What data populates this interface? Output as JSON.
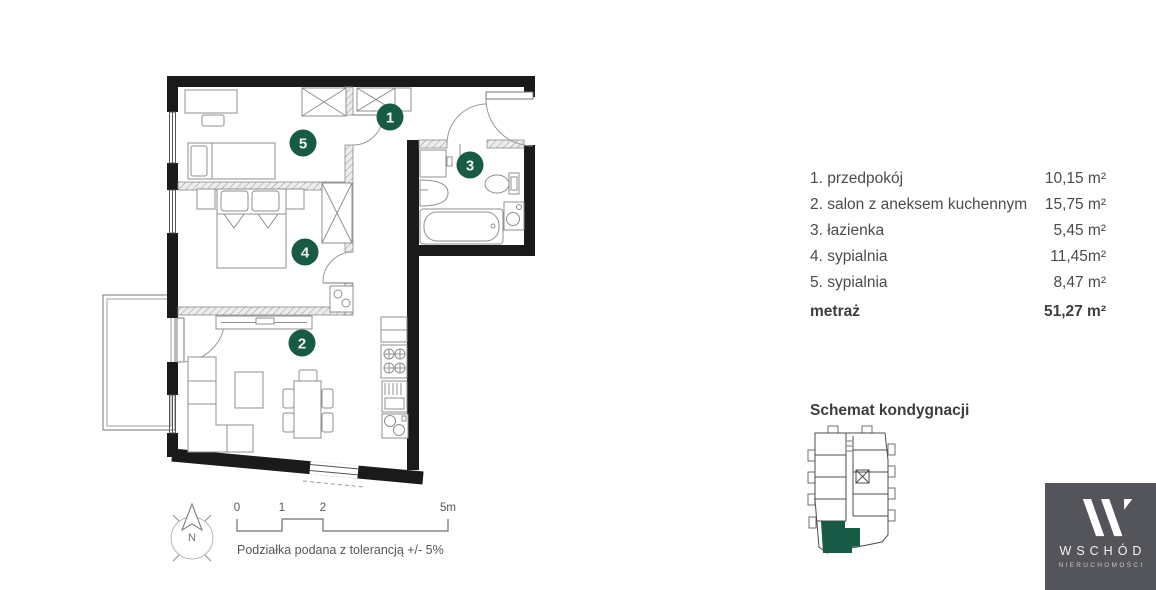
{
  "legend": {
    "rooms": [
      {
        "number": "1",
        "label": "1. przedpokój",
        "area": "10,15 m²"
      },
      {
        "number": "2",
        "label": "2. salon z aneksem kuchennym",
        "area": "15,75 m²"
      },
      {
        "number": "3",
        "label": "3. łazienka",
        "area": "5,45 m²"
      },
      {
        "number": "4",
        "label": "4. sypialnia",
        "area": "11,45m²"
      },
      {
        "number": "5",
        "label": "5. sypialnia",
        "area": "8,47 m²"
      }
    ],
    "total_label": "metraż",
    "total_area": "51,27 m²"
  },
  "schematic": {
    "title": "Schemat kondygnacji"
  },
  "scale_bar": {
    "ticks": [
      "0",
      "1",
      "2",
      "5m"
    ],
    "note": "Podziałka podana z tolerancją +/- 5%"
  },
  "compass": {
    "label": "N"
  },
  "logo": {
    "title": "WSCHÓD",
    "subtitle": "NIERUCHOMOŚCI",
    "bg_color": "#54555a"
  },
  "colors": {
    "accent_green": "#175a45",
    "wall": "#1a1a1a",
    "text": "#4b4b4d"
  }
}
